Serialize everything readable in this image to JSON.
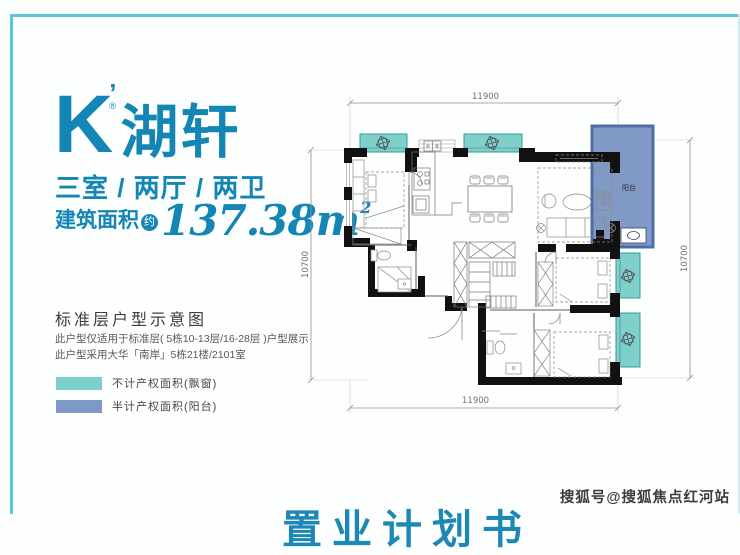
{
  "frame": {
    "accent_color": "#59c6da"
  },
  "brand": {
    "k": "K",
    "apos": "’",
    "reg": "®",
    "name": "湖轩",
    "color": "#1486b6"
  },
  "specs": {
    "layout": "三室 / 两厅 / 两卫",
    "area_label": "建筑面积",
    "area_badge": "约",
    "area_value": "137.38",
    "area_unit": "m",
    "area_exp": "2"
  },
  "section": {
    "title": "标准层户型示意图",
    "notes": [
      "此户型仅适用于标准层( 5栋10-13层/16-28层 )户型展示",
      "此户型采用大华「南岸」5栋21楼/2101室"
    ]
  },
  "legend": {
    "items": [
      {
        "label": "不计产权面积(飘窗)",
        "color": "#7fd0cb"
      },
      {
        "label": "半计产权面积(阳台)",
        "color": "#7e99c6"
      }
    ]
  },
  "floorplan": {
    "dims": {
      "top": "11900",
      "bottom": "11900",
      "left": "10700",
      "right": "10700"
    },
    "balcony_label": "阳台",
    "colors": {
      "bay_window": "#7fd0cb",
      "balcony": "#8099c5",
      "wall": "#111111"
    }
  },
  "watermark": "搜狐号@搜狐焦点红河站",
  "cutoff_heading": "置业计划书"
}
